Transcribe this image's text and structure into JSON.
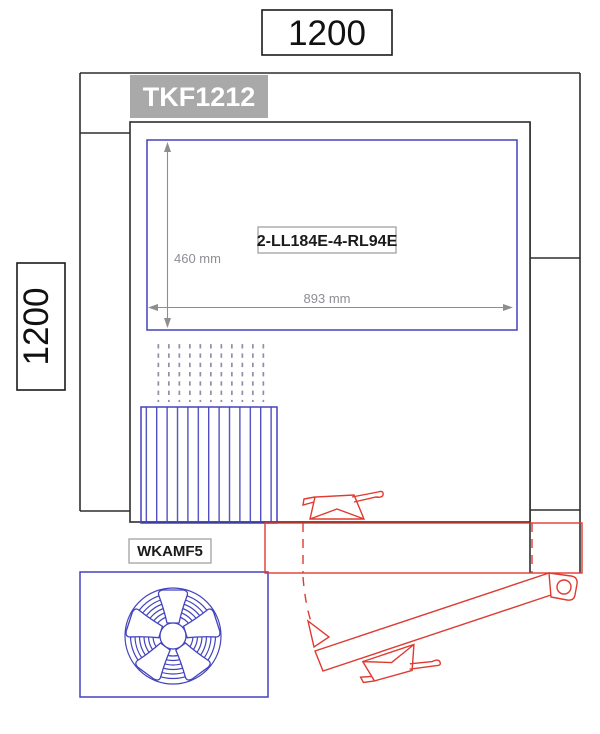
{
  "labels": {
    "width_total": "1200",
    "height_total": "1200",
    "unit": "TKF1212",
    "component": "2-LL184E-4-RL94E",
    "inner_height": "460 mm",
    "inner_width": "893 mm",
    "filter": "WKAMF5"
  },
  "colors": {
    "blue": "#4343bd",
    "red": "#e03a30",
    "dim_gray": "#8d8d93",
    "label_gray": "#9a9a9a",
    "frame_black": "#2e2e2e",
    "unit_fill": "#a9a9a9",
    "unit_text": "#ffffff",
    "grid_dot": "#8f8fa8"
  }
}
